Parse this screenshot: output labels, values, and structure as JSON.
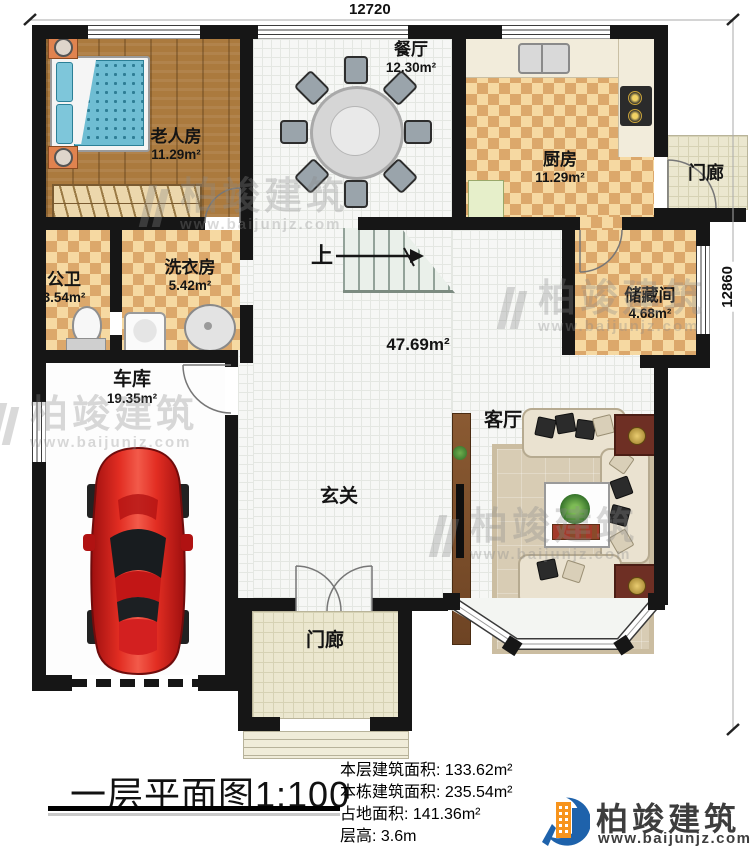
{
  "dimensions": {
    "top": "12720",
    "right": "12860"
  },
  "rooms": {
    "bedroom": {
      "name": "老人房",
      "area": "11.29m²"
    },
    "dining": {
      "name": "餐厅",
      "area": "12.30m²"
    },
    "kitchen": {
      "name": "厨房",
      "area": "11.29m²"
    },
    "porch_top": {
      "name": "门廊"
    },
    "storage": {
      "name": "储藏间",
      "area": "4.68m²"
    },
    "bath": {
      "name": "公卫",
      "area": "3.54m²"
    },
    "laundry": {
      "name": "洗衣房",
      "area": "5.42m²"
    },
    "garage": {
      "name": "车库",
      "area": "19.35m²"
    },
    "hall": {
      "area": "47.69m²",
      "entry_label": "玄关",
      "living_label": "客厅",
      "stairs_label": "上"
    },
    "porch_bottom": {
      "name": "门廊"
    }
  },
  "caption": {
    "title": "一层平面图1:100",
    "stats": [
      "本层建筑面积: 133.62m²",
      "本栋建筑面积: 235.54m²",
      "占地面积: 141.36m²",
      "层高: 3.6m"
    ],
    "brand": {
      "name": "柏竣建筑",
      "url": "www.baijunjz.com"
    }
  },
  "watermark": {
    "name": "柏竣建筑",
    "url": "www.baijunjz.com"
  },
  "colors": {
    "wall": "#161616",
    "wood_floor": "#ab7a3e",
    "tile_light": "#f6d9a2",
    "tile_dark": "#dca86b",
    "bed_blue": "#6fbdd3",
    "car_red": "#d41818",
    "brand_blue": "#1e62ab",
    "brand_orange": "#f7941d"
  }
}
